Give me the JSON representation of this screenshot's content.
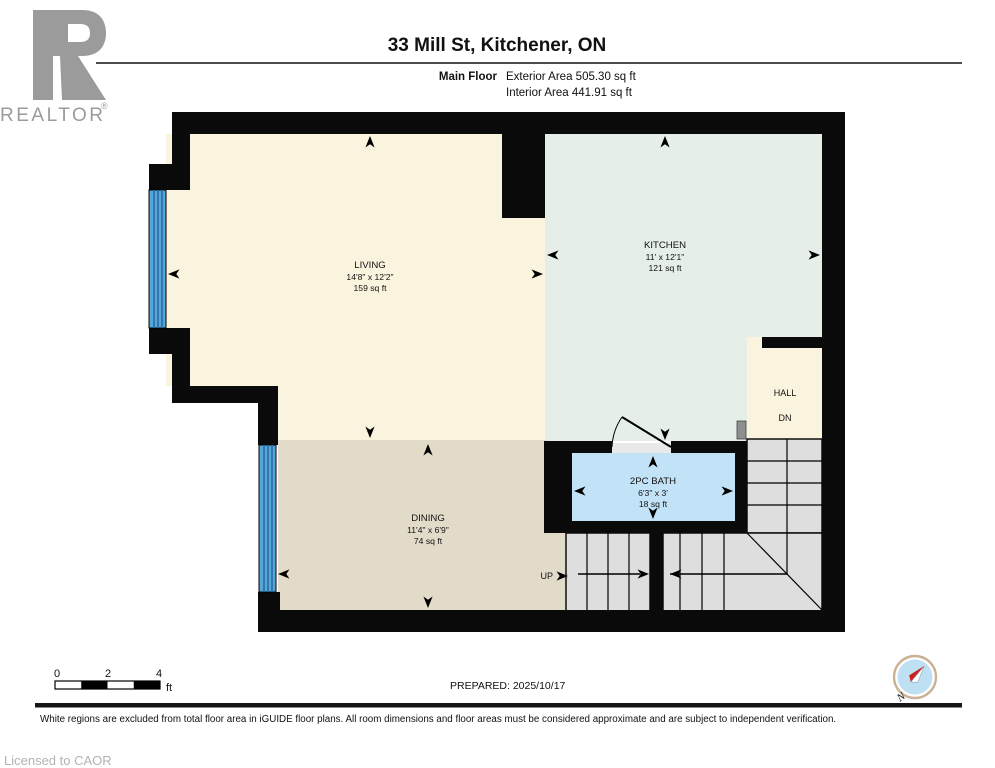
{
  "header": {
    "title": "33 Mill St, Kitchener, ON",
    "floor_label": "Main Floor",
    "exterior_area": "Exterior Area 505.30 sq ft",
    "interior_area": "Interior Area 441.91 sq ft",
    "logo_word": "REALTOR",
    "logo_reg": "®"
  },
  "rooms": {
    "living": {
      "name": "LIVING",
      "dims": "14'8\" x 12'2\"",
      "area": "159 sq ft"
    },
    "kitchen": {
      "name": "KITCHEN",
      "dims": "11' x 12'1\"",
      "area": "121 sq ft"
    },
    "dining": {
      "name": "DINING",
      "dims": "11'4\" x 6'9\"",
      "area": "74 sq ft"
    },
    "bath": {
      "name": "2PC BATH",
      "dims": "6'3\" x 3'",
      "area": "18 sq ft"
    },
    "hall": {
      "name": "HALL"
    }
  },
  "stairs": {
    "up_label": "UP",
    "dn_label": "DN"
  },
  "scale_bar": {
    "tick0": "0",
    "tick2": "2",
    "tick4": "4",
    "unit": "ft"
  },
  "footer": {
    "prepared": "PREPARED: 2025/10/17",
    "disclaimer": "White regions are excluded from total floor area in iGUIDE floor plans. All room dimensions and floor areas must be considered approximate and are subject to independent verification.",
    "licensed": "Licensed to CAOR",
    "compass_label": "N"
  },
  "colors": {
    "wall": "#0a0a0a",
    "living": "#faf3dd",
    "kitchen": "#e6efe7",
    "dining": "#e3dbc9",
    "bath": "#c2e2f7",
    "hall": "#faf3dd",
    "stairs": "#dedede",
    "window": "#55a7da",
    "window_stripe": "#2a6da3",
    "threshold": "#e9e9e9",
    "logo_gray": "#9b9b9b",
    "compass_ring": "#c9b194",
    "compass_face": "#bfe0f2",
    "compass_red": "#cc2020"
  }
}
